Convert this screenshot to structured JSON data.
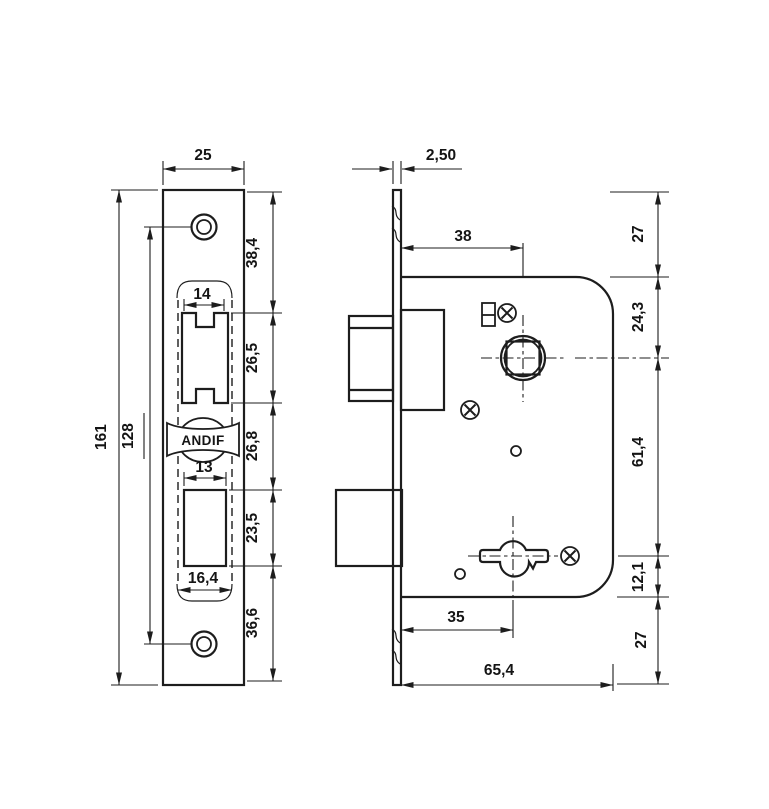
{
  "drawing_title": "Mortise lock dimensional drawing",
  "brand": "ANDIF",
  "colors": {
    "ink": "#1d1d1d",
    "paper": "#ffffff"
  },
  "front_view": {
    "plate_width": "25",
    "plate_height": "161",
    "screw_hole_spacing": "128",
    "top_to_latch_cutout": "38,4",
    "latch_width": "14",
    "latch_cutout_height": "26,5",
    "latch_to_deadbolt": "26,8",
    "deadbolt_width": "13",
    "deadbolt_cutout_height": "23,5",
    "case_width": "16,4",
    "deadbolt_to_bottom": "36,6"
  },
  "side_view": {
    "faceplate_thickness": "2,50",
    "spindle_backset": "38",
    "top_margin": "27",
    "case_top_to_spindle": "24,3",
    "spindle_to_keyhole": "61,4",
    "keyhole_to_case_bottom": "12,1",
    "bottom_margin": "27",
    "keyhole_backset": "35",
    "case_depth": "65,4"
  }
}
